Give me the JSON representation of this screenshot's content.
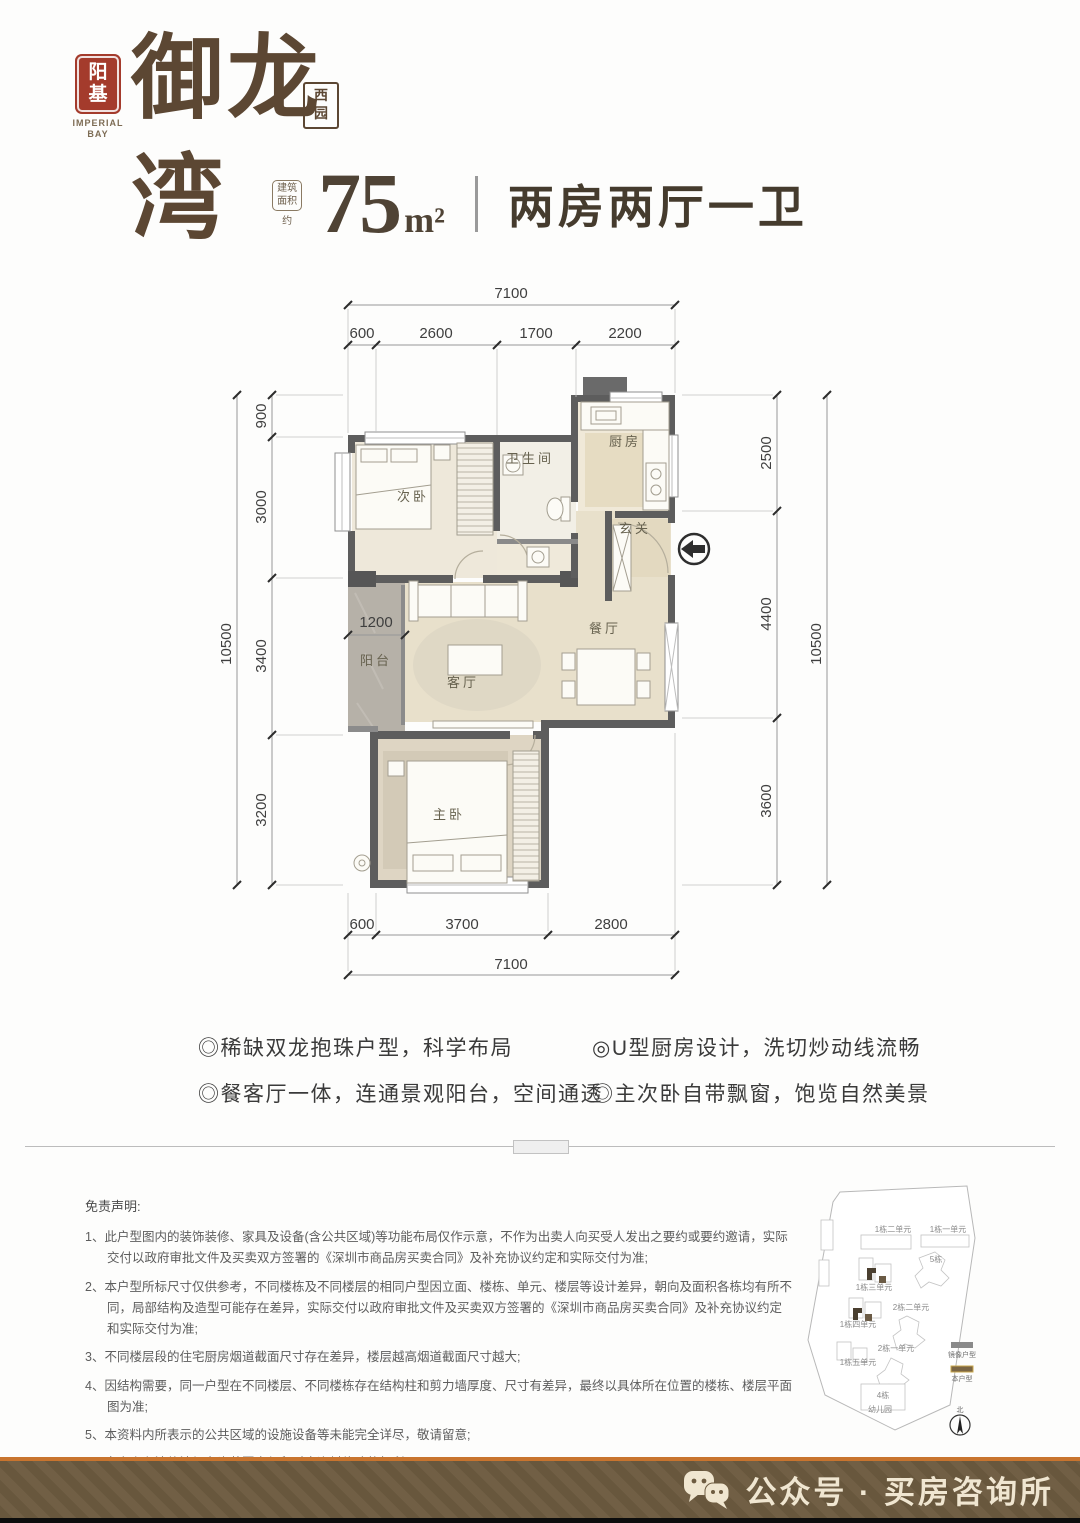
{
  "logo": {
    "seal_line1": "阳",
    "seal_line2": "基",
    "brand_en1": "IMPERIAL",
    "brand_en2": "BAY",
    "brand_cn": "御龙湾",
    "sub_line1": "西",
    "sub_line2": "园"
  },
  "header": {
    "area_label1": "建筑",
    "area_label2": "面积",
    "area_about": "约",
    "area_value": "75",
    "area_unit": "m²",
    "layout_title": "两房两厅一卫"
  },
  "floorplan": {
    "rooms": {
      "bedroom2": "次卧",
      "bath": "卫生间",
      "kitchen": "厨房",
      "foyer": "玄关",
      "dining": "餐厅",
      "balcony": "阳台",
      "living": "客厅",
      "master": "主卧"
    },
    "balcony_dim": "1200",
    "dims": {
      "top_total": "7100",
      "top_segments": [
        "600",
        "2600",
        "1700",
        "2200"
      ],
      "bottom_total": "7100",
      "bottom_segments": [
        "600",
        "3700",
        "2800"
      ],
      "left_total": "10500",
      "left_segments": [
        "900",
        "3000",
        "3400",
        "3200"
      ],
      "right_total": "10500",
      "right_segments": [
        "2500",
        "4400",
        "3600"
      ]
    }
  },
  "features": [
    "◎稀缺双龙抱珠户型，科学布局",
    "◎U型厨房设计，洗切炒动线流畅",
    "◎餐客厅一体，连通景观阳台，空间通透",
    "◎主次卧自带飘窗，饱览自然美景"
  ],
  "disclaimer": {
    "title": "免责声明:",
    "items": [
      "1、此户型图内的装饰装修、家具及设备(含公共区域)等功能布局仅作示意，不作为出卖人向买受人发出之要约或要约邀请，实际交付以政府审批文件及买卖双方签署的《深圳市商品房买卖合同》及补充协议约定和实际交付为准;",
      "2、本户型所标尺寸仅供参考，不同楼栋及不同楼层的相同户型因立面、楼栋、单元、楼层等设计差异，朝向及面积各栋均有所不同，局部结构及造型可能存在差异，实际交付以政府审批文件及买卖双方签署的《深圳市商品房买卖合同》及补充协议约定和实际交付为准;",
      "3、不同楼层段的住宅厨房烟道截面尺寸存在差异，楼层越高烟道截面尺寸越大;",
      "4、因结构需要，同一户型在不同楼层、不同楼栋存在结构柱和剪力墙厚度、尺寸有差异，最终以具体所在位置的楼栋、楼层平面图为准;",
      "5、本资料内所表示的公共区域的设施设备等未能完全详尽，敬请留意;",
      "6、出卖人在法律法规允许范围内保留对本资料修改的权利;",
      "7、本资料制作时间2024年10月。"
    ]
  },
  "siteplan": {
    "buildings": [
      {
        "label": "1栋二单元"
      },
      {
        "label": "1栋一单元"
      },
      {
        "label": "5栋"
      },
      {
        "label": "1栋三单元"
      },
      {
        "label": "2栋二单元"
      },
      {
        "label": "1栋四单元"
      },
      {
        "label": "2栋一单元"
      },
      {
        "label": "1栋五单元"
      },
      {
        "label": "4栋"
      },
      {
        "label": "幼儿园"
      }
    ],
    "legend": [
      {
        "label": "镜像户型",
        "color": "#8a8a8a"
      },
      {
        "label": "本户型",
        "color": "#7a6544"
      }
    ],
    "compass": "北"
  },
  "footer": {
    "account_label": "公众号 · 买房咨询所"
  }
}
